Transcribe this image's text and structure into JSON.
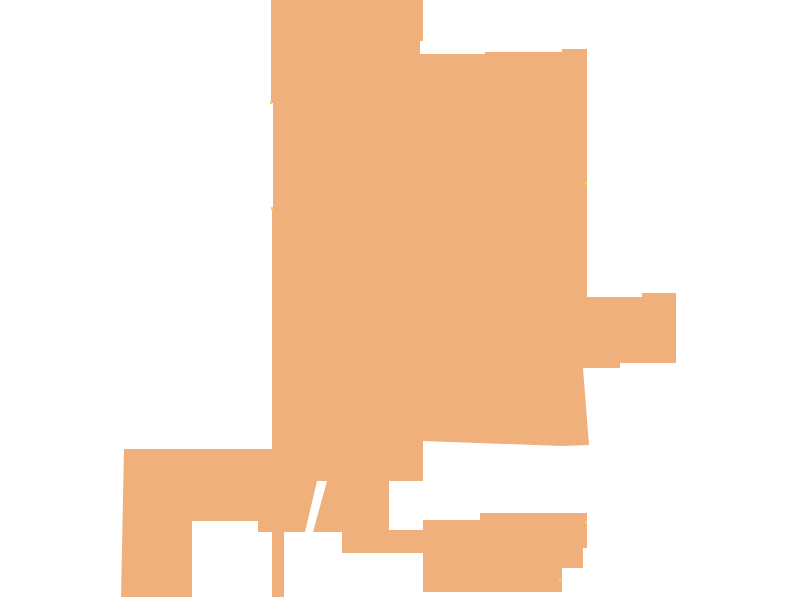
{
  "canvas": {
    "width": 800,
    "height": 600,
    "background": "#ffffff"
  },
  "map": {
    "region": {
      "label": "filled-boundary-region",
      "fill": "#EFB07C",
      "points": [
        [
          271,
          0
        ],
        [
          423,
          0
        ],
        [
          423,
          41
        ],
        [
          420,
          41
        ],
        [
          420,
          54
        ],
        [
          485,
          54
        ],
        [
          485,
          52
        ],
        [
          562,
          52
        ],
        [
          562,
          49
        ],
        [
          587,
          49
        ],
        [
          587,
          297
        ],
        [
          642,
          297
        ],
        [
          642,
          293
        ],
        [
          676,
          293
        ],
        [
          676,
          363
        ],
        [
          620,
          363
        ],
        [
          620,
          368
        ],
        [
          583,
          368
        ],
        [
          589,
          445
        ],
        [
          562,
          446
        ],
        [
          423,
          441
        ],
        [
          423,
          481
        ],
        [
          389,
          481
        ],
        [
          389,
          530
        ],
        [
          423,
          530
        ],
        [
          423,
          520
        ],
        [
          480,
          520
        ],
        [
          480,
          513
        ],
        [
          587,
          513
        ],
        [
          587,
          548
        ],
        [
          583,
          548
        ],
        [
          583,
          568
        ],
        [
          562,
          568
        ],
        [
          562,
          592
        ],
        [
          423,
          592
        ],
        [
          423,
          553
        ],
        [
          342,
          553
        ],
        [
          342,
          532
        ],
        [
          313,
          532
        ],
        [
          327,
          481
        ],
        [
          317,
          481
        ],
        [
          305,
          532
        ],
        [
          284,
          532
        ],
        [
          284,
          597
        ],
        [
          272,
          597
        ],
        [
          272,
          532
        ],
        [
          258,
          532
        ],
        [
          258,
          521
        ],
        [
          192,
          521
        ],
        [
          192,
          597
        ],
        [
          121,
          597
        ],
        [
          124,
          449
        ],
        [
          272,
          449
        ],
        [
          272,
          210
        ],
        [
          273,
          210
        ],
        [
          273,
          103
        ],
        [
          271,
          103
        ]
      ]
    },
    "markers": {
      "label": "boundary-corner-specks",
      "color": "#EDD83D",
      "width": 2,
      "height": 3,
      "positions": [
        [
          270,
          101
        ],
        [
          271,
          207
        ],
        [
          585,
          182
        ],
        [
          585,
          521
        ],
        [
          559,
          579
        ]
      ]
    }
  }
}
